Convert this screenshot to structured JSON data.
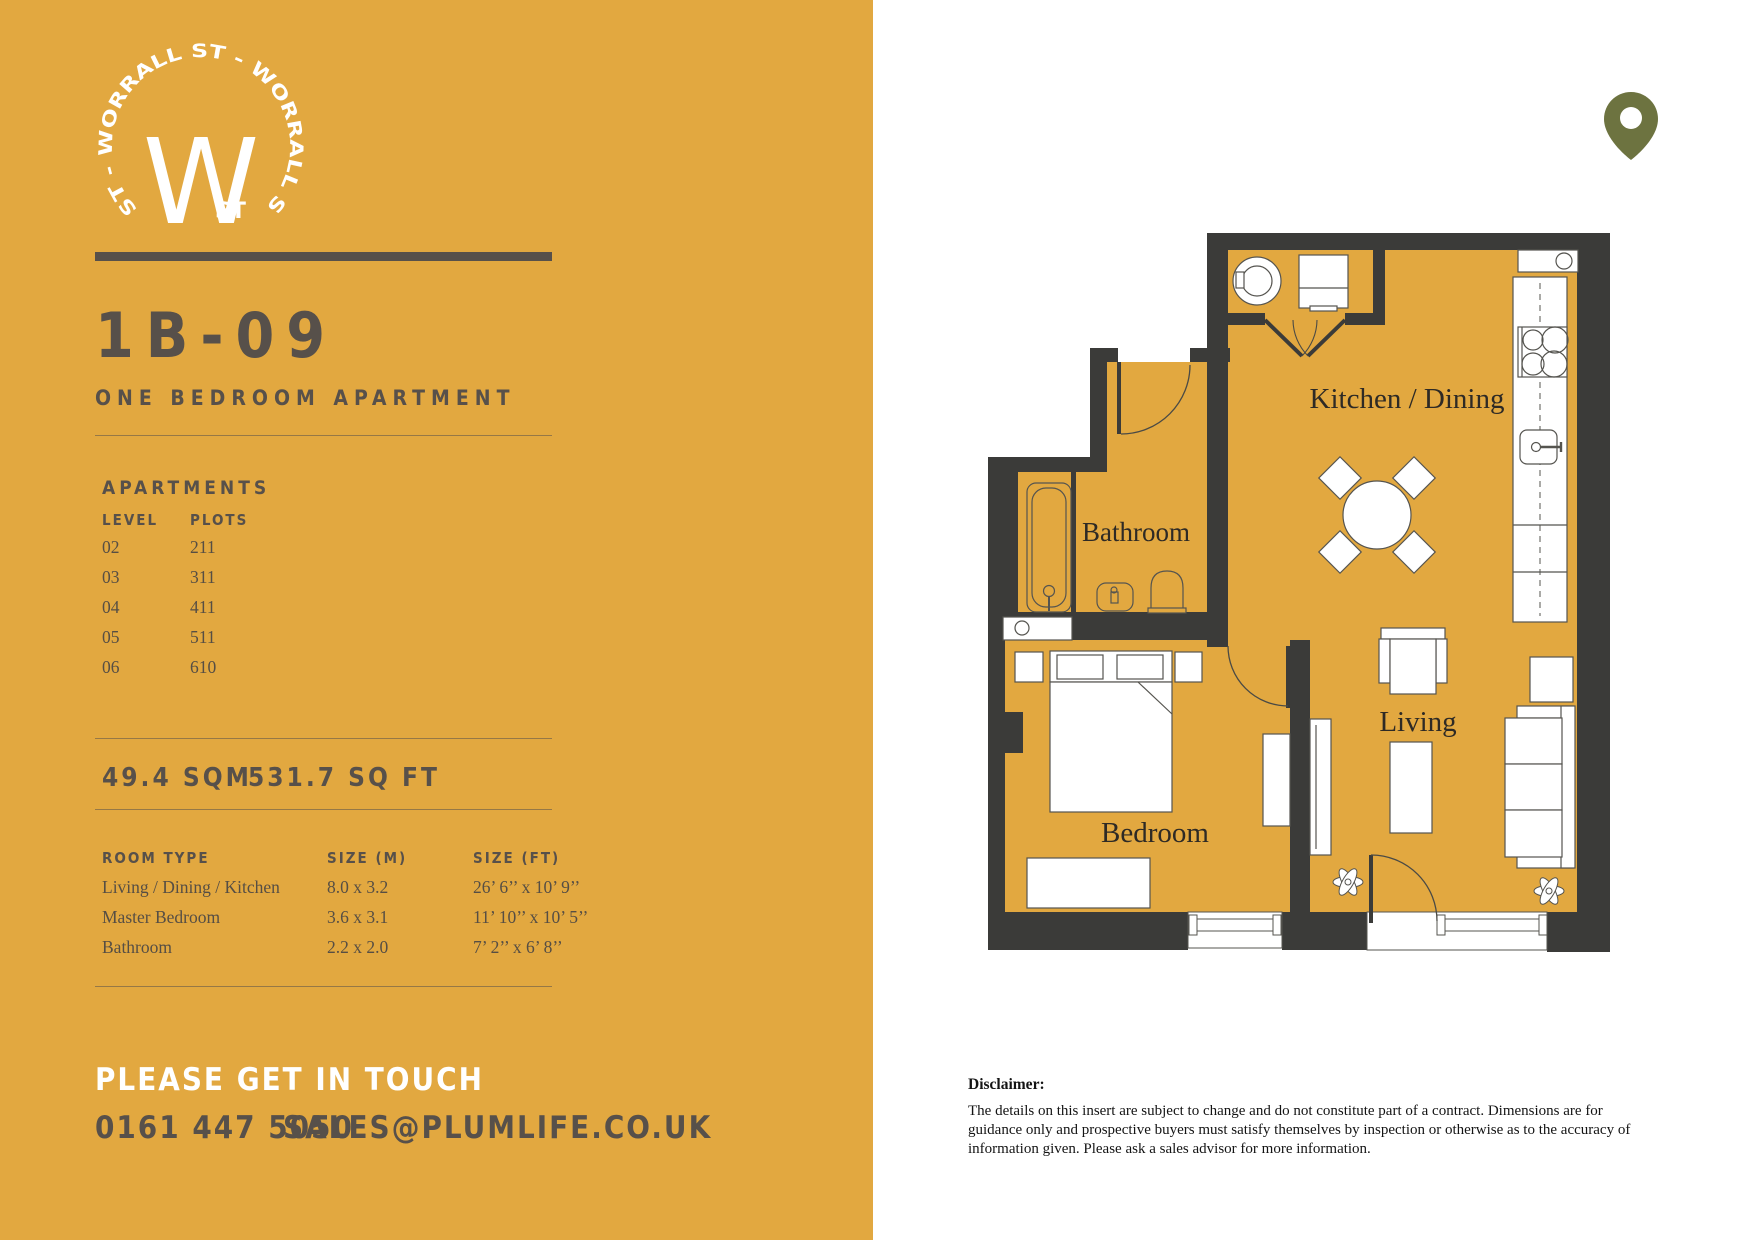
{
  "brand": {
    "ring_text": "ST - WORRALL ST - WORRALL ST",
    "monogram": "W",
    "monogram_sub": "ST"
  },
  "listing": {
    "code": "1B-09",
    "type": "ONE BEDROOM APARTMENT"
  },
  "apartments": {
    "heading": "APARTMENTS",
    "col_level": "LEVEL",
    "col_plots": "PLOTS",
    "rows": [
      [
        "02",
        "211"
      ],
      [
        "03",
        "311"
      ],
      [
        "04",
        "411"
      ],
      [
        "05",
        "511"
      ],
      [
        "06",
        "610"
      ]
    ]
  },
  "area": {
    "sqm": "49.4 SQM",
    "sqft": "531.7 SQ FT"
  },
  "rooms": {
    "col_room": "ROOM TYPE",
    "col_m": "SIZE (M)",
    "col_ft": "SIZE (FT)",
    "rows": [
      [
        "Living / Dining / Kitchen",
        "8.0 x 3.2",
        "26’ 6’’ x 10’ 9’’"
      ],
      [
        "Master Bedroom",
        "3.6 x 3.1",
        "11’ 10’’ x 10’ 5’’"
      ],
      [
        "Bathroom",
        "2.2 x 2.0",
        "7’ 2’’ x 6’ 8’’"
      ]
    ]
  },
  "contact": {
    "heading": "PLEASE GET IN TOUCH",
    "phone": "0161 447 5050",
    "email": "SALES@PLUMLIFE.CO.UK"
  },
  "floorplan": {
    "labels": {
      "kitchen": "Kitchen / Dining",
      "bathroom": "Bathroom",
      "bedroom": "Bedroom",
      "living": "Living"
    }
  },
  "disclaimer": {
    "heading": "Disclaimer:",
    "body": "The details on this insert are subject to change and do not constitute part of a contract. Dimensions are for guidance only and prospective buyers must satisfy themselves by inspection or otherwise as to the accuracy of information given. Please ask a sales advisor for more information."
  },
  "colors": {
    "yellow": "#E2A840",
    "wall": "#3B3B39",
    "text_brown": "#57504A",
    "pin_olive": "#6D7340"
  }
}
